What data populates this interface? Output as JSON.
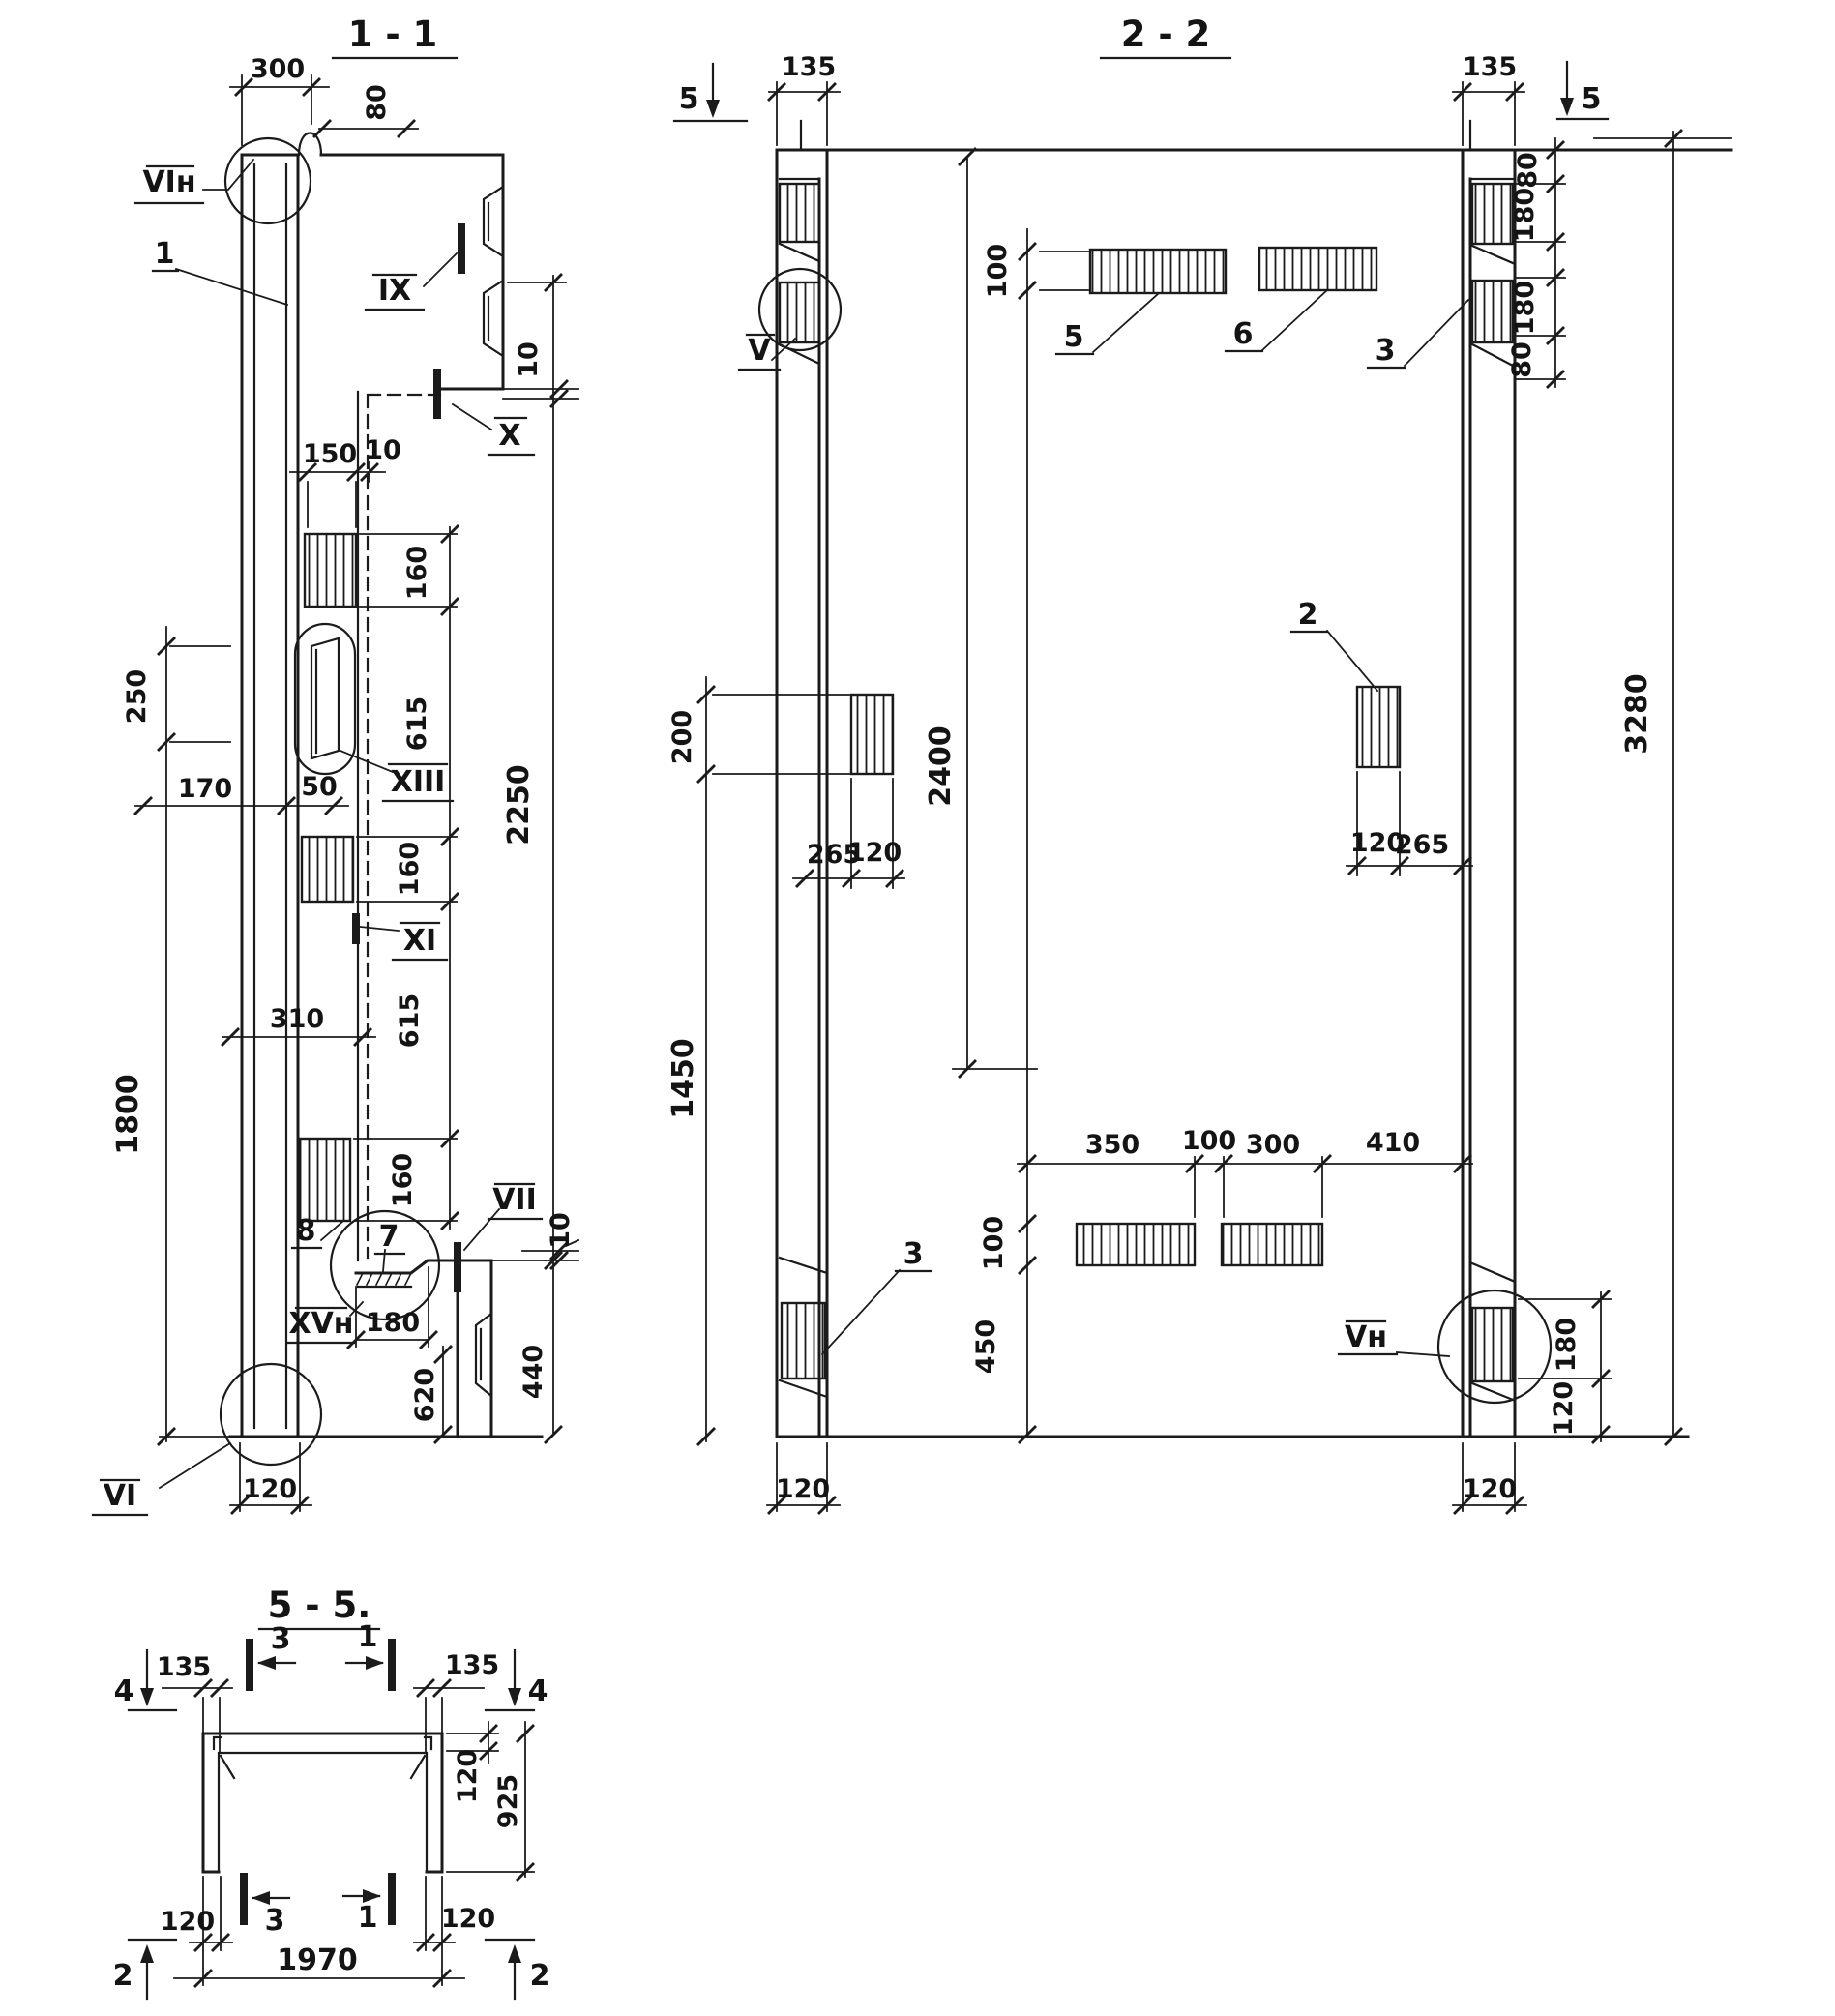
{
  "meta": {
    "drawing_type": "reinforced concrete panel shop drawing, sections",
    "ink_color": "#1b1b1b",
    "paper_color": "#ffffff"
  },
  "texts": {
    "s11_title": "1 - 1",
    "s11_d300": "300",
    "s11_d80": "80",
    "s11_l_vin": "VIн",
    "s11_l_1": "1",
    "s11_l_ix": "IX",
    "s11_d10t": "10",
    "s11_l_x": "X",
    "s11_d150": "150",
    "s11_d10m": "10",
    "s11_d160a": "160",
    "s11_d615a": "615",
    "s11_d160b": "160",
    "s11_d615b": "615",
    "s11_d160c": "160",
    "s11_d2250": "2250",
    "s11_d250": "250",
    "s11_d170": "170",
    "s11_d50": "50",
    "s11_l_xiii": "XIII",
    "s11_l_xi": "XI",
    "s11_d310": "310",
    "s11_d1800": "1800",
    "s11_l_8": "8",
    "s11_l_7": "7",
    "s11_l_vii": "VII",
    "s11_l_xvn": "XVн",
    "s11_d180": "180",
    "s11_d620": "620",
    "s11_d440": "440",
    "s11_d10b": "10",
    "s11_l_vi": "VI",
    "s11_d120": "120",
    "s22_title": "2 - 2",
    "s22_m5l": "5",
    "s22_d135l": "135",
    "s22_d135r": "135",
    "s22_m5r": "5",
    "s22_d80t": "80",
    "s22_d180t": "180",
    "s22_d180m": "180",
    "s22_d80m": "80",
    "s22_l_v": "V",
    "s22_d100t": "100",
    "s22_l_5": "5",
    "s22_l_6": "6",
    "s22_l_3t": "3",
    "s22_d3280": "3280",
    "s22_d200": "200",
    "s22_d2400": "2400",
    "s22_l_2": "2",
    "s22_d265l": "265",
    "s22_d120l": "120",
    "s22_d120r": "120",
    "s22_d265r": "265",
    "s22_d1450": "1450",
    "s22_d350": "350",
    "s22_d100c": "100",
    "s22_d300": "300",
    "s22_d410": "410",
    "s22_d100b": "100",
    "s22_l_3b": "3",
    "s22_d450": "450",
    "s22_l_vn": "Vн",
    "s22_d180b": "180",
    "s22_d120b": "120",
    "s22_d120bl": "120",
    "s22_d120br": "120",
    "s55_title": "5 - 5.",
    "s55_m4l": "4",
    "s55_d135a": "135",
    "s55_m3t": "3",
    "s55_m1t": "1",
    "s55_d135b": "135",
    "s55_m4r": "4",
    "s55_d120w": "120",
    "s55_d925": "925",
    "s55_m3b": "3",
    "s55_m1b": "1",
    "s55_d120gl": "120",
    "s55_d120gr": "120",
    "s55_d1970": "1970",
    "s55_m2l": "2",
    "s55_m2r": "2"
  }
}
